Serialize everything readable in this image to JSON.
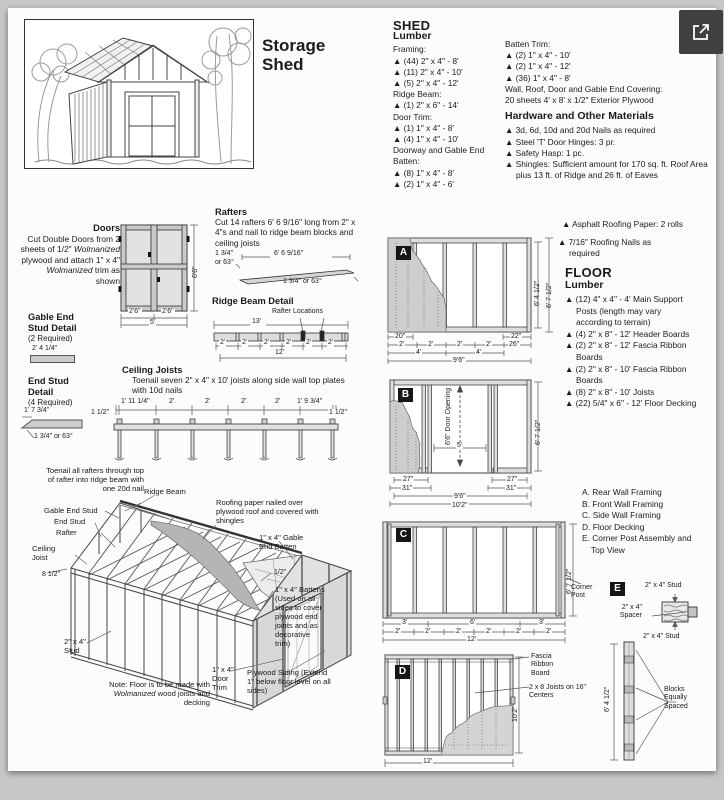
{
  "icons": {
    "expand": "open-in-new-icon"
  },
  "title": {
    "line1": "Storage",
    "line2": "Shed"
  },
  "shed_lumber": {
    "heading": "SHED",
    "subheading": "Lumber",
    "framing_label": "Framing:",
    "framing": [
      "▲ (44) 2\" x 4\" - 8'",
      "▲ (11) 2\" x 4\" - 10'",
      "▲ (5) 2\" x 4\" - 12'"
    ],
    "ridge_label": "Ridge Beam:",
    "ridge": [
      "▲ (1) 2\" x 6\" - 14'"
    ],
    "door_trim_label": "Door Trim:",
    "door_trim": [
      "▲ (1) 1\" x 4\" - 8'",
      "▲ (4) 1\" x 4\" - 10'"
    ],
    "doorway_label": "Doorway and Gable End Batten:",
    "doorway": [
      "▲ (8) 1\" x 4\" - 8'",
      "▲ (2) 1\" x 4\" - 6'"
    ],
    "batten_label": "Batten Trim:",
    "batten": [
      "▲ (2) 1\" x 4\" - 10'",
      "▲ (2) 1\" x 4\" - 12'",
      "▲ (36) 1\" x 4\" - 8'"
    ],
    "covering_line1": "Wall, Roof, Door and Gable End Covering:",
    "covering_line2": "20 sheets 4' x 8' x 1/2\" Exterior Plywood"
  },
  "hardware": {
    "heading": "Hardware and Other Materials",
    "items": [
      "▲ 3d, 6d, 10d and 20d Nails as required",
      "▲ Steel 'T' Door Hinges: 3 pr.",
      "▲ Safety Hasp: 1 pc.",
      "▲ Shingles: Sufficient amount for 170 sq. ft. Roof Area plus 13 ft. of Ridge and 26 ft. of Eaves"
    ],
    "extra": [
      "▲ Asphalt Roofing Paper: 2 rolls",
      "▲ 7/16\" Roofing Nails as required"
    ]
  },
  "floor_lumber": {
    "heading": "FLOOR",
    "subheading": "Lumber",
    "items": [
      "▲ (12) 4\" x 4\" - 4' Main Support Posts (length may vary according to terrain)",
      "▲ (4) 2\" x 8\" - 12' Header Boards",
      "▲ (2) 2\" x 8\" - 12' Fascia Ribbon Boards",
      "▲ (2) 2\" x 8\" - 10' Fascia Ribbon Boards",
      "▲ (8) 2\" x 8\" - 10' Joists",
      "▲ (22) 5/4\" x 6\" - 12' Floor Decking"
    ]
  },
  "legend": {
    "items": [
      "A. Rear Wall Framing",
      "B. Front Wall Framing",
      "C. Side Wall Framing",
      "D. Floor Decking",
      "E. Corner Post Assembly and Top View"
    ]
  },
  "doors": {
    "heading": "Doors",
    "seg1": "Cut Double Doors from 2 sheets of 1/2\" ",
    "em1": "Wolmanized",
    "seg2": " plywood and attach 1\" x 4\" ",
    "em2": "Wolmanized",
    "seg3": " trim as shown",
    "dim_height": "6'6\"",
    "dim_left_leaf": "2'6\"",
    "dim_right_leaf": "2'6\"",
    "dim_width": "5'"
  },
  "gable_end_stud": {
    "heading": "Gable End Stud Detail",
    "qty": "(2 Required)",
    "dim": "2' 4 1/4\""
  },
  "end_stud": {
    "heading": "End Stud Detail",
    "qty": "(4 Required)",
    "dim_length": "1' 7 3/4\"",
    "dim_angle": "1 3/4\" or 63°"
  },
  "rafters": {
    "heading": "Rafters",
    "text": "Cut 14 rafters 6' 6 9/16\" long from 2\" x 4\"s and nail to ridge beam blocks and ceiling joists",
    "dim_left_a": "1 3/4\"",
    "dim_left_b": "or 63°",
    "dim_length": "6' 6 9/16\"",
    "dim_right": "1 3/4\" or 63°"
  },
  "ridge_beam_detail": {
    "heading": "Ridge Beam Detail",
    "callout": "Rafter Locations",
    "dim_top": "13'",
    "dims": [
      "2'",
      "2'",
      "2'",
      "2'",
      "2'",
      "2'"
    ],
    "dim_bottom": "12'"
  },
  "ceiling_joists": {
    "heading": "Ceiling Joists",
    "text": "Toenail seven 2\" x 4\" x 10' joists along side wall top plates with 10d nails",
    "dim_left": "1 1/2\"",
    "dims": [
      "1' 11 1/4\"",
      "2'",
      "2'",
      "2'",
      "2'",
      "1' 9 3/4\""
    ],
    "dim_right": "1 1/2\""
  },
  "iso": {
    "toenail_note": "Toenail all rafters through top of rafter into ridge beam with one 20d nail",
    "ridge_beam": "Ridge Beam",
    "roofing_note": "Roofing paper nailed over plywood roof and covered with shingles",
    "gable_end_stud": "Gable End Stud",
    "end_stud": "End Stud",
    "rafter": "Rafter",
    "ceiling_joist": "Ceiling Joist",
    "dim_eave": "8 1/2\"",
    "gable_batten": "1\" x 4\" Gable End Batten",
    "dim_batten": "1/2\"",
    "battens_note": "1\" x 4\" Battens (Used on all sides to cover plywood end joints and as decorative trim)",
    "stud": "2\" x 4\" Stud",
    "door_trim": "1\" x 4\" Door Trim",
    "plywood_note": "Plywood Siding (Extend 1\" below floor level on all sides)",
    "floor_note_seg1": "Note: Floor is to be made with ",
    "floor_note_em": "Wolmanized",
    "floor_note_seg2": " wood joists and decking"
  },
  "panel_a": {
    "badge": "A",
    "row1": [
      "20\"",
      "22\""
    ],
    "row2": [
      "2'",
      "2'",
      "2'",
      "2'",
      "26\""
    ],
    "row3": [
      "4'",
      "4'"
    ],
    "row4": "9'6\"",
    "height_inner": "6' 4 1/2\"",
    "height_outer": "6' 7 1/2\""
  },
  "panel_b": {
    "badge": "B",
    "door_label": "6'6\" Door Opening",
    "dim_door_w": "5'",
    "dim_l1": "27\"",
    "dim_l2": "31\"",
    "dim_r1": "27\"",
    "dim_r2": "31\"",
    "dim_mid": "9'6\"",
    "dim_total": "10'2\"",
    "height": "6' 7 1/2\""
  },
  "panel_c": {
    "badge": "C",
    "row1": [
      "3'",
      "6'",
      "3'"
    ],
    "row2": [
      "2'",
      "2'",
      "2'",
      "2'",
      "2'",
      "2'"
    ],
    "dim_total": "12'",
    "height": "6' 7 1/2\"",
    "corner_post": "Corner Post"
  },
  "panel_d": {
    "badge": "D",
    "fascia_label": "Fascia Ribbon Board",
    "joists_label": "2 x 8 Joists on 16\" Centers",
    "height": "10'2\"",
    "dim_total": "12'"
  },
  "panel_e": {
    "badge": "E",
    "stud_top": "2\" x 4\" Stud",
    "spacer": "2\" x 4\" Spacer",
    "stud_bottom": "2\" x 4\" Stud",
    "height": "6' 4 1/2\"",
    "blocks_note": "Blocks Equally Spaced"
  }
}
